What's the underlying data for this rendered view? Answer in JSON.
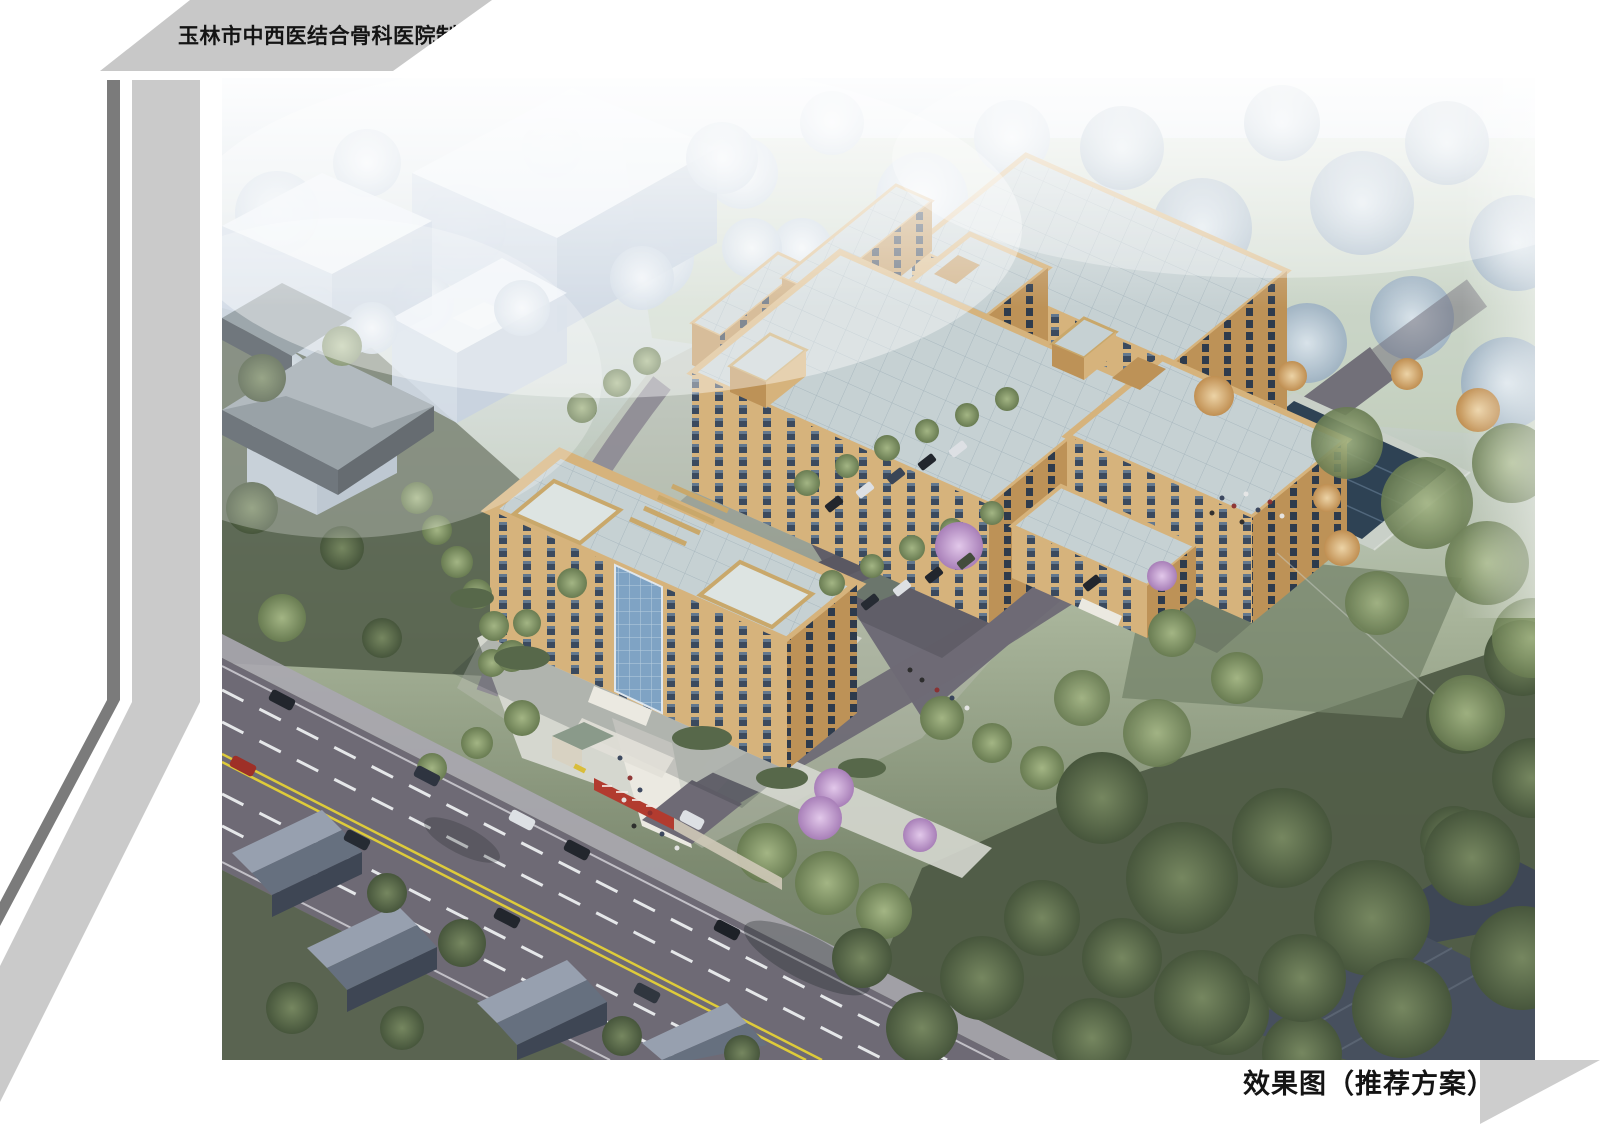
{
  "page": {
    "title": "玉林市中西医结合骨科医院制剂中心",
    "caption": "效果图（推荐方案）"
  },
  "scene": {
    "type": "architectural-aerial-rendering",
    "elements": [
      "main-office-building-with-roof-trellis",
      "production-slab-building",
      "rear-ward-slab-building",
      "service-tower",
      "rear-low-wings",
      "east-building-with-annex",
      "connecting-bridges",
      "reflecting-pool",
      "parking-lot-with-cars",
      "entrance-gate-with-red-sign-wall",
      "main-road-with-traffic",
      "existing-ghost-massing-blocks",
      "existing-gray-hip-roof-buildings",
      "residential-gable-houses",
      "dense-tree-landscape",
      "pedestrian-groups"
    ]
  },
  "palette": {
    "banner_gray": "#c8c8c8",
    "stripe_dark": "#7b7b7b",
    "stripe_light": "#cacaca",
    "corner_triangle": "#cdcdcd",
    "text_black": "#141414",
    "sky_top": "#e7edf4",
    "haze_blue": "#c9d6e4",
    "lawn_pale": "#bfcab6",
    "lawn_green": "#74836a",
    "ground_dark": "#4f5b46",
    "facade_tan": "#d6b37c",
    "facade_shade": "#bd9257",
    "facade_light": "#e3cf9f",
    "window_dark": "#3b4a5e",
    "roof_light": "#c6d1d3",
    "roof_line": "#a9b8bf",
    "glass_blue": "#7fa3c4",
    "ghost_top": "#eaf0f6",
    "ghost_left": "#c6d2e1",
    "ghost_right": "#b5c4d6",
    "gray_block_roof": "#7d8a90",
    "gray_block_wall": "#414a52",
    "tree_green": "#7e9164",
    "tree_dark": "#5a6a4d",
    "tree_haze": "#dfe8f0",
    "tree_blue": "#b3c4d4",
    "blossom_pink": "#c4a0d2",
    "autumn_orange": "#d8ab72",
    "road_asphalt": "#6e6a75",
    "road_dark": "#57545e",
    "lane_yellow": "#decb3a",
    "lane_white": "#eceef0",
    "sidewalk": "#aaa7b0",
    "plaza_light": "#d5d7cf",
    "path_white": "#ebe9e1",
    "pool_deck": "#c9d0c8",
    "pool_water": "#2e4254",
    "house_wall": "#3e4654",
    "house_roof_light": "#97a0af",
    "house_roof_dark": "#66707f",
    "bigroof_dark": "#47505e",
    "car_dark": "#22262d",
    "car_white": "#dde0e4",
    "car_red": "#9e2f27",
    "gate_red": "#b23b2f",
    "barrier_yellow": "#d9bd3a"
  }
}
